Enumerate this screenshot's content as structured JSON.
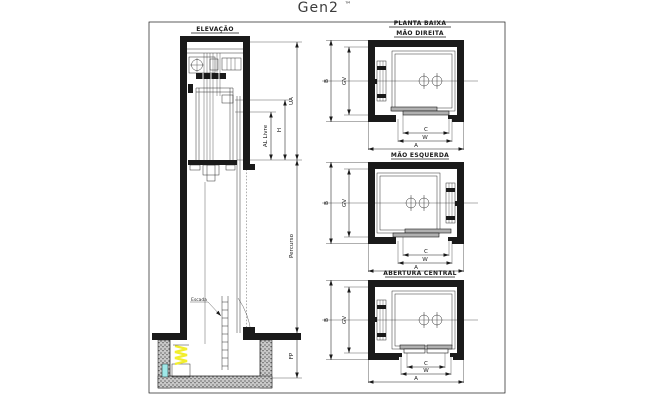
{
  "page": {
    "title": "Gen2",
    "trademark": "™"
  },
  "elevation": {
    "label": "ELEVAÇÃO",
    "dims": {
      "ua": "UA",
      "h": "H",
      "al": "AL Livre",
      "percurso": "Percurso",
      "fp": "FP"
    },
    "notes": {
      "ladder": "Escada"
    }
  },
  "plans": {
    "label": "PLANTA BAIXA",
    "views": [
      {
        "label": "MÃO DIREITA",
        "dims": {
          "b": "B",
          "gv": "GV",
          "c": "C",
          "w": "W",
          "a": "A"
        }
      },
      {
        "label": "MÃO ESQUERDA",
        "dims": {
          "b": "B",
          "gv": "GV",
          "c": "C",
          "w": "W",
          "a": "A"
        }
      },
      {
        "label": "ABERTURA CENTRAL",
        "dims": {
          "b": "B",
          "gv": "GV",
          "c": "C",
          "w": "W",
          "a": "A"
        }
      }
    ]
  },
  "colors": {
    "ink": "#1a1a1a",
    "buffer_spring": "#f2ee2c",
    "buffer_pad": "#9fe8e8",
    "door_panel": "#b0b0b0",
    "pit_fill": "#c9c9c9"
  }
}
